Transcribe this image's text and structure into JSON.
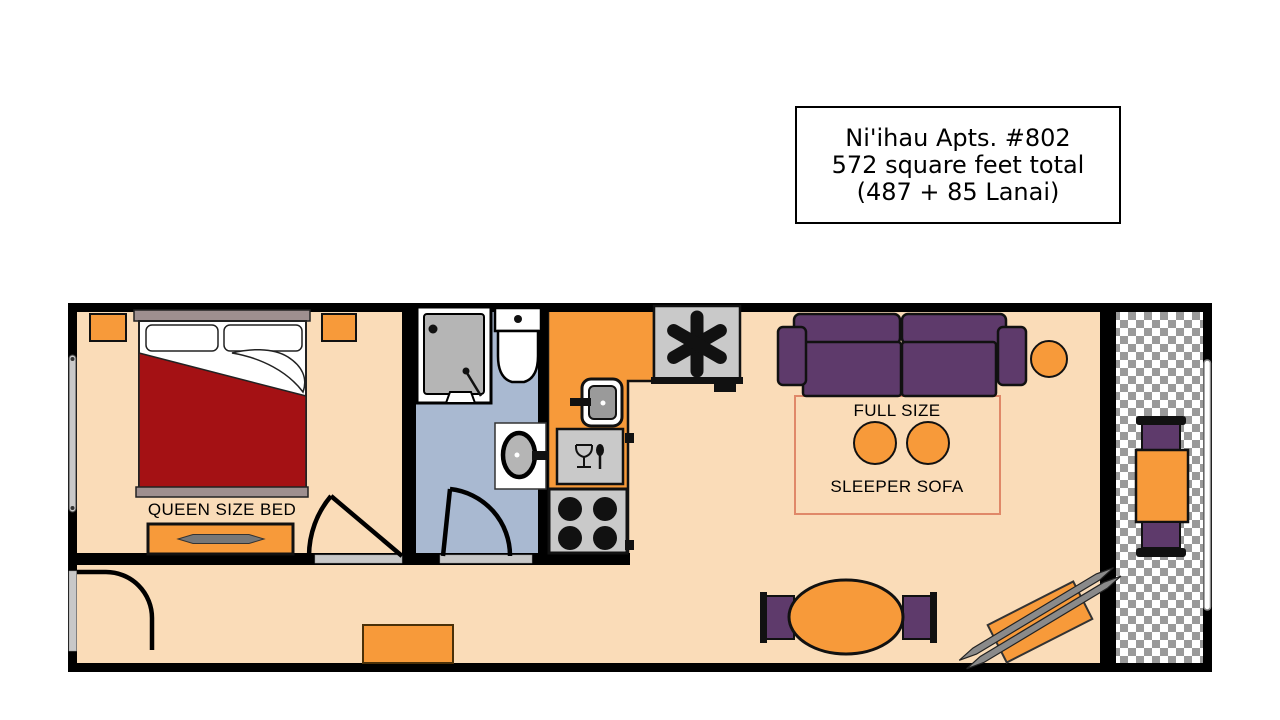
{
  "title_box": {
    "line1": "Ni'ihau Apts. #802",
    "line2": "572 square feet total",
    "line3": "(487 + 85 Lanai)"
  },
  "floor_plan": {
    "bed_label": "QUEEN SIZE BED",
    "sofa_label_line1": "FULL SIZE",
    "sofa_label_line2": "SLEEPER SOFA"
  },
  "icons": {
    "refrigerator_symbol": "✱",
    "dishwasher_symbol": "wine-glass-and-spoon",
    "shower_symbol": "drain-and-wand",
    "lanai_floor_pattern": "gray-white-checkerboard"
  },
  "colors": {
    "background": "#FFFFFF",
    "wall": "#000000",
    "floor": "#FADCB8",
    "bathroom_floor": "#A9B9D1",
    "furniture_orange": "#F79A3A",
    "sofa_purple": "#5E3A6B",
    "bed_red": "#A41114",
    "bed_frame": "#9E8F8F",
    "appliance_gray": "#C9C9C9",
    "check_gray": "#9A9A9A",
    "sleeper_outline": "#E08868",
    "threshold": "#C8C8C8"
  }
}
